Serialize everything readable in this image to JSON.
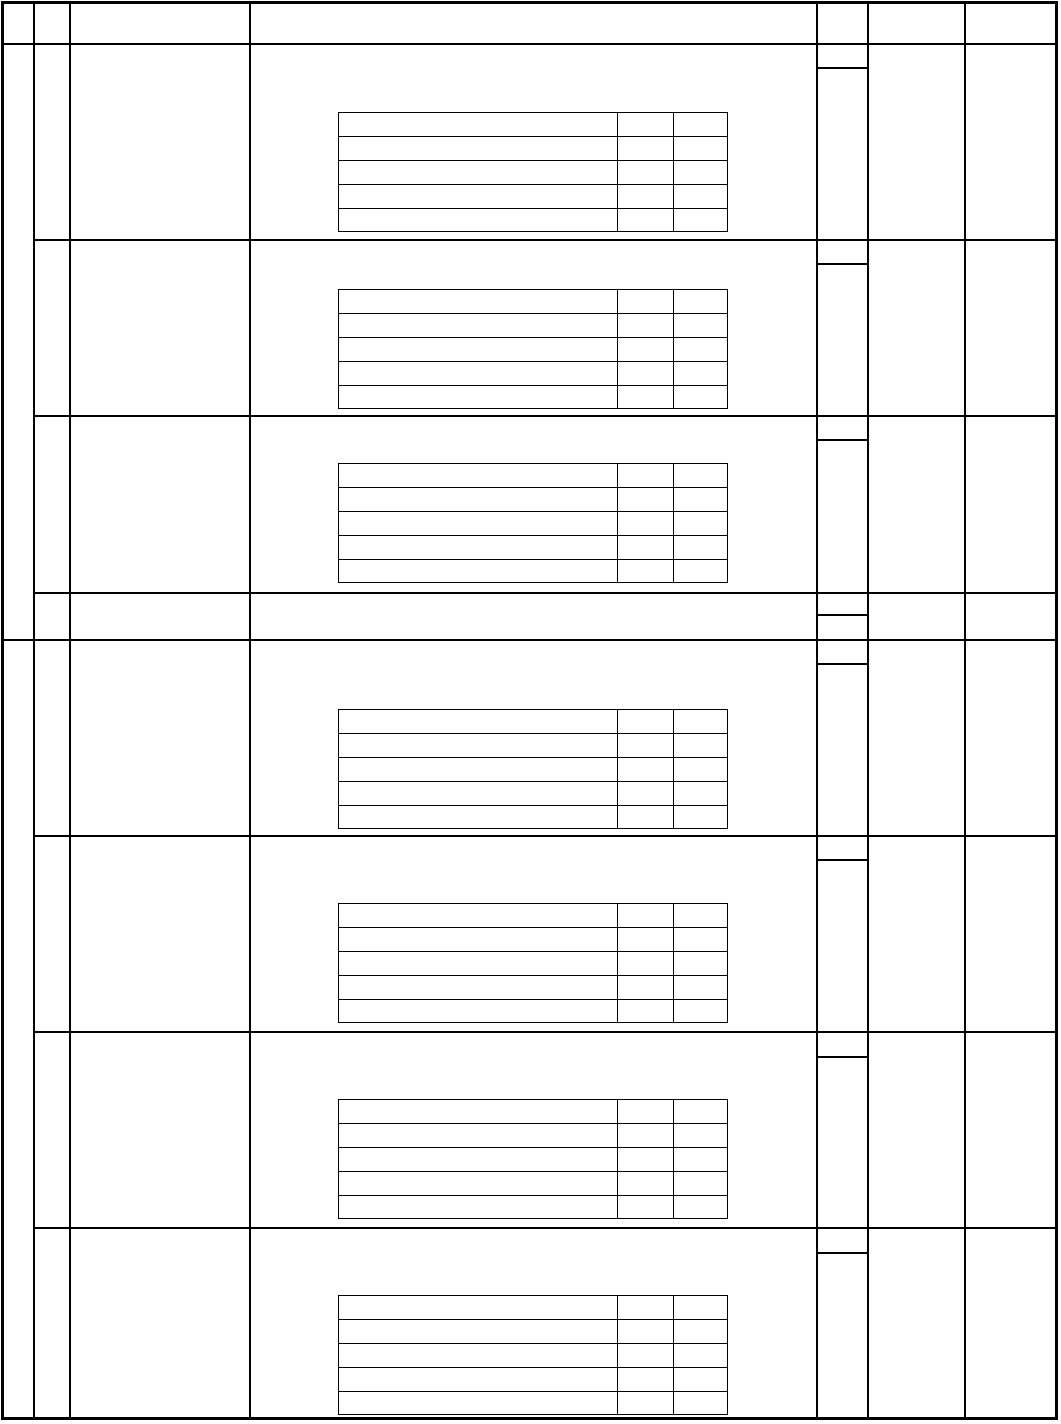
{
  "document": {
    "type": "blank-table-form",
    "title": "",
    "visible_text": "",
    "background_color": "#ffffff",
    "line_color": "#000000"
  },
  "canvas": {
    "width": 1061,
    "height": 1424
  },
  "outer_border": {
    "left": 1,
    "top": 1,
    "width": 1057,
    "height": 1419,
    "stroke": 3
  },
  "grid": {
    "stroke": 2,
    "column_lines_x": [
      34,
      70,
      250,
      817,
      868,
      965
    ],
    "header_divider_y": 44,
    "section_divider_y": 640,
    "row_divider_y": [
      240,
      416,
      593,
      836,
      1032,
      1228
    ],
    "row_divider_start_x": 34,
    "column_bounds_x": [
      1,
      34,
      70,
      250,
      817,
      868,
      965,
      1058
    ],
    "row_bounds_y": [
      44,
      240,
      416,
      593,
      640,
      836,
      1032,
      1228,
      1420
    ],
    "merged_first_column_sections": [
      {
        "top": 44,
        "bottom": 640
      },
      {
        "top": 640,
        "bottom": 1420
      }
    ]
  },
  "col5_subcells": {
    "x1": 817,
    "x2": 868,
    "divider_y": [
      68,
      264,
      440,
      615,
      664,
      860,
      1057,
      1253
    ]
  },
  "inner_tables": {
    "count": 7,
    "left": 338,
    "width": 390,
    "rows": 5,
    "row_height": 24,
    "column_offsets": [
      278,
      334
    ],
    "stroke": 1,
    "top_y_list": [
      112,
      289,
      463,
      709,
      903,
      1099,
      1295
    ],
    "cells_content": ""
  }
}
